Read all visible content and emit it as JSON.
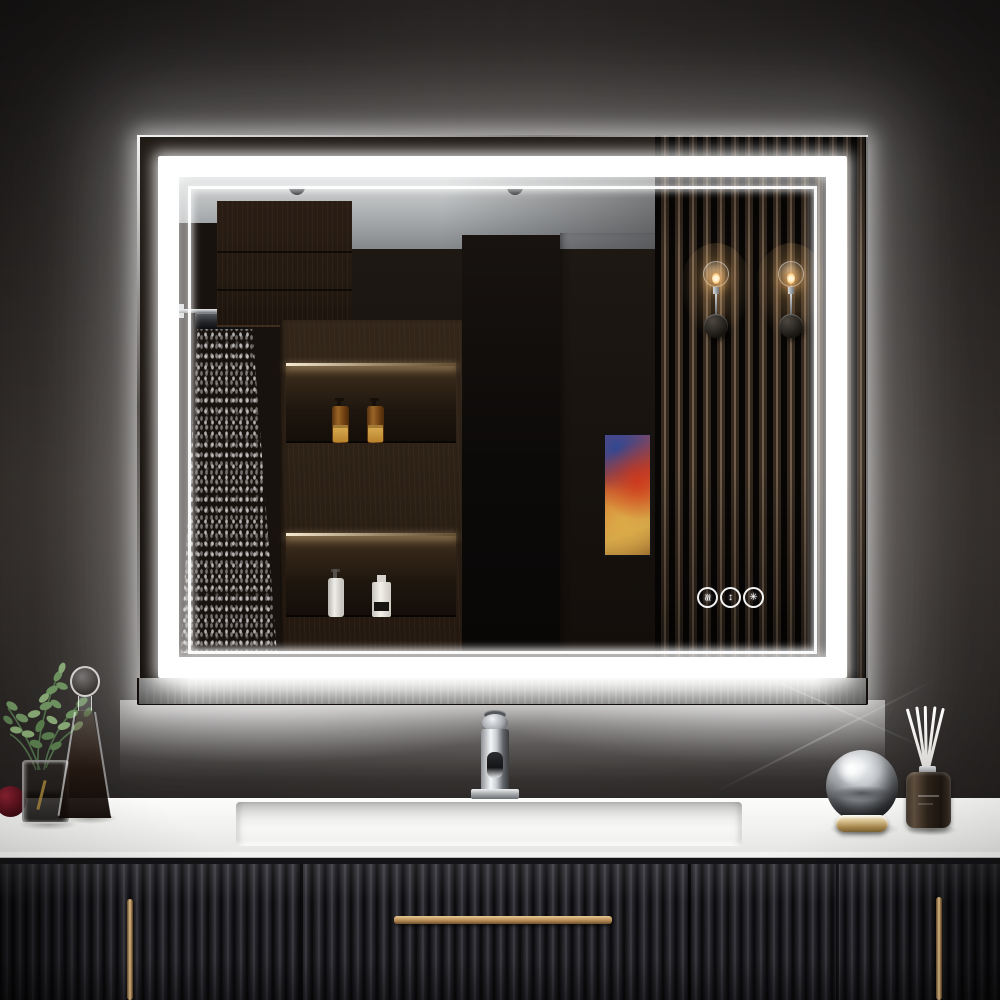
{
  "scene": {
    "description": "Product photo: rectangular backlit LED bathroom vanity mirror with double light band on a dark wall, reflecting a shower, wood shelving with toiletry bottles, a gray wall with abstract art and a slatted wood panel with two sconces; below is a white countertop with chrome faucet, greenery, glass decanter, mirrored ball, reed diffuser and a black fluted vanity cabinet with brass handles",
    "objects": [
      "led-mirror",
      "touch-controls",
      "shower-reflection",
      "shelf-reflection",
      "wardrobe-reflection",
      "artwork-reflection",
      "slat-panel-reflection",
      "wall-sconces",
      "faucet",
      "sink",
      "countertop",
      "vanity-cabinet",
      "plant",
      "glass-vase",
      "glass-decanter",
      "mirror-ball",
      "reed-diffuser"
    ]
  },
  "palette": {
    "wall": "#2b2726",
    "glow": "#ffffff",
    "led_band": "#ffffff",
    "counter": "#f2f2f0",
    "cabinet": "#1b1b1f",
    "brass": "#c9a06a",
    "reflection_wood": "#2b2014",
    "slat_wood": "#5f4f40",
    "gray_wall": "#9b9da1",
    "ceiling": "#c3c5c7",
    "amber_bottle": "#8a5a22",
    "sconce_warm": "#ffc87d",
    "art_red": "#c2452a",
    "art_blue": "#2f4f92",
    "art_gold": "#cfa145"
  },
  "mirror": {
    "touch_controls": [
      {
        "name": "anti-fog-button",
        "glyph": "≋"
      },
      {
        "name": "dimmer-button",
        "glyph": "↕"
      },
      {
        "name": "color-temp-button",
        "glyph": "✳"
      }
    ]
  }
}
